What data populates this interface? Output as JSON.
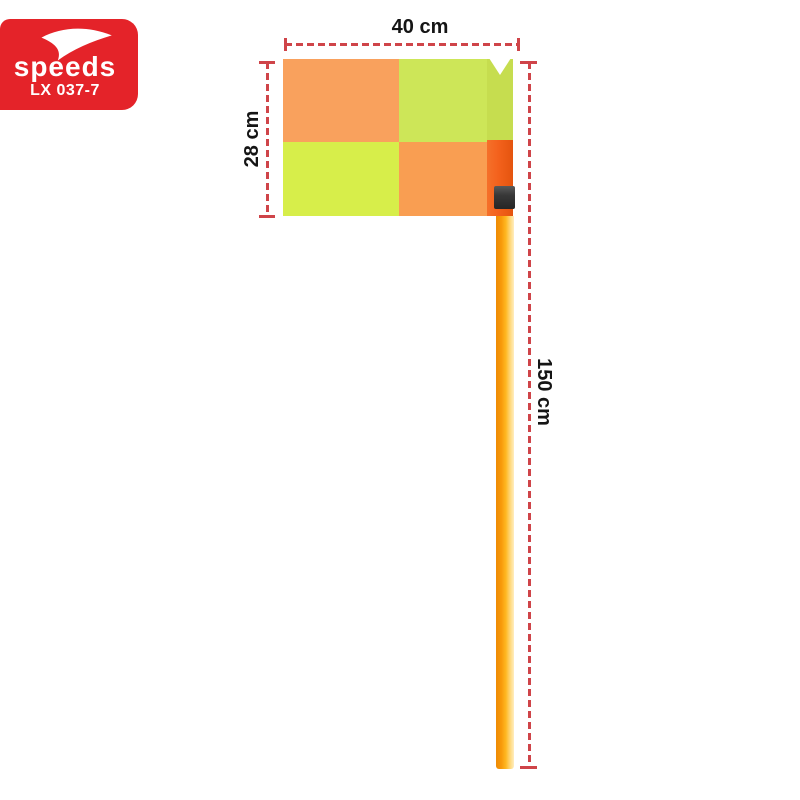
{
  "brand": {
    "name": "speeds",
    "model": "LX 037-7",
    "box_color": "#e42329",
    "text_color": "#ffffff",
    "swoosh_icon": "speeds-swoosh"
  },
  "annotations": {
    "flag_width_label": "40 cm",
    "flag_height_label": "28 cm",
    "pole_height_label": "150 cm",
    "line_color": "#cf4449",
    "label_color": "#151515"
  },
  "product": {
    "name": "checkered corner flag with pole",
    "flag_colors": {
      "top_left": "#f9a15d",
      "top_right": "#cde658",
      "bottom_left": "#d7ee4a",
      "bottom_right": "#f99e52",
      "pole_sleeve": "#f3611c"
    },
    "pole_color": "#f89a0a",
    "clip_color": "#383838"
  }
}
